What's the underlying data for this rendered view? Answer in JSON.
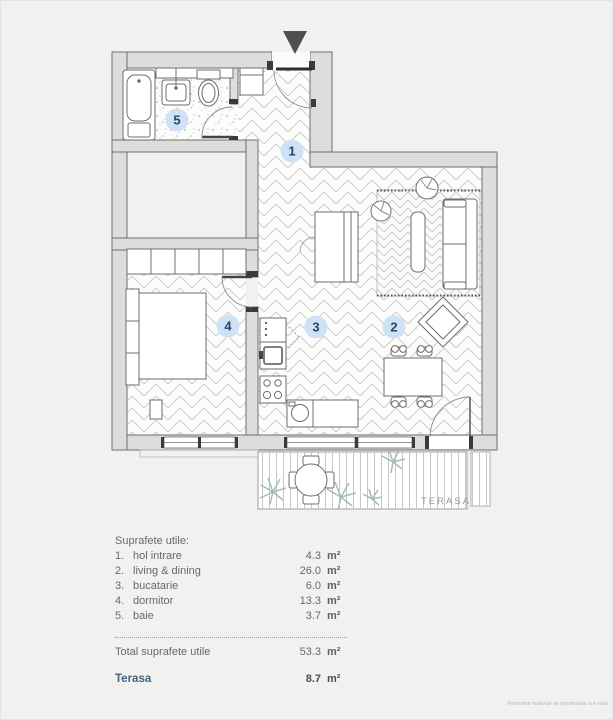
{
  "page": {
    "footer_note": "Prezentul material de prezentare are cara"
  },
  "plan": {
    "terrace_label": "TERASA",
    "rooms": [
      {
        "number": "1",
        "name": "hol intrare"
      },
      {
        "number": "2",
        "name": "living & dining"
      },
      {
        "number": "3",
        "name": "bucatarie"
      },
      {
        "number": "4",
        "name": "dormitor"
      },
      {
        "number": "5",
        "name": "baie"
      }
    ],
    "colors": {
      "label_bg": "#cfe2f5",
      "label_text": "#24466b",
      "wall_fill": "#dddddb",
      "plant": "#a3bfae",
      "terasa_accent": "#46637a"
    }
  },
  "legend": {
    "title": "Suprafete utile:",
    "items": [
      {
        "num": "1.",
        "name": "hol intrare",
        "value": "4.3",
        "unit": "m²"
      },
      {
        "num": "2.",
        "name": "living & dining",
        "value": "26.0",
        "unit": "m²"
      },
      {
        "num": "3.",
        "name": "bucatarie",
        "value": "6.0",
        "unit": "m²"
      },
      {
        "num": "4.",
        "name": "dormitor",
        "value": "13.3",
        "unit": "m²"
      },
      {
        "num": "5.",
        "name": "baie",
        "value": "3.7",
        "unit": "m²"
      }
    ],
    "total": {
      "label": "Total suprafete utile",
      "value": "53.3",
      "unit": "m²"
    },
    "terasa": {
      "label": "Terasa",
      "value": "8.7",
      "unit": "m²"
    }
  }
}
